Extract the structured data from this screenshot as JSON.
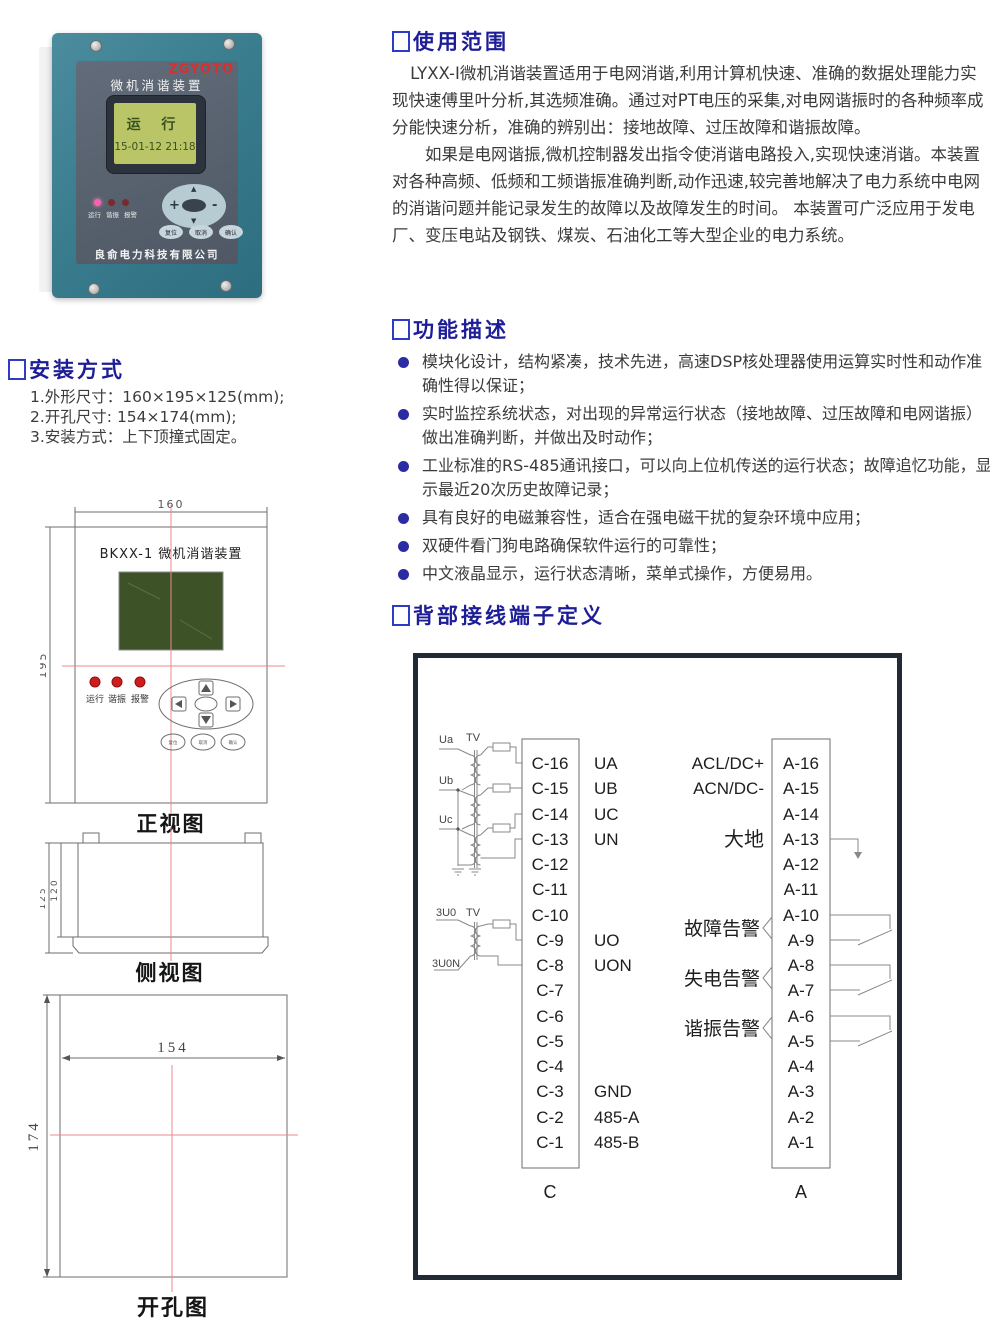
{
  "photo": {
    "brand": "ZGYOTO",
    "title": "微机消谐装置",
    "lcd_status": "运 行",
    "lcd_time": "15-01-12 21:18",
    "leds": [
      "运行",
      "谐振",
      "报警"
    ],
    "keys": {
      "plus": "+",
      "minus": "-",
      "up": "▲",
      "down": "▼"
    },
    "buttons": [
      "复位",
      "取消",
      "确认"
    ],
    "company": "良俞电力科技有限公司"
  },
  "usage": {
    "title": "使用范围",
    "p1": "LYXX-I微机消谐装置适用于电网消谐,利用计算机快速、准确的数据处理能力实现快速傅里叶分析,其选频准确。通过对PT电压的采集,对电网谐振时的各种频率成分能快速分析，准确的辨别出：接地故障、过压故障和谐振故障。",
    "p2": "如果是电网谐振,微机控制器发出指令使消谐电路投入,实现快速消谐。本装置对各种高频、低频和工频谐振准确判断,动作迅速,较完善地解决了电力系统中电网的消谐问题并能记录发生的故障以及故障发生的时间。 本装置可广泛应用于发电厂、变压电站及钢铁、煤炭、石油化工等大型企业的电力系统。"
  },
  "features": {
    "title": "功能描述",
    "items": [
      "模块化设计，结构紧凑，技术先进，高速DSP核处理器使用运算实时性和动作准确性得以保证；",
      "实时监控系统状态，对出现的异常运行状态（接地故障、过压故障和电网谐振）做出准确判断，并做出及时动作；",
      "工业标准的RS-485通讯接口，可以向上位机传送的运行状态；故障追忆功能，显示最近20次历史故障记录；",
      "具有良好的电磁兼容性，适合在强电磁干扰的复杂环境中应用；",
      "双硬件看门狗电路确保软件运行的可靠性；",
      "中文液晶显示，运行状态清晰，菜单式操作，方便易用。"
    ]
  },
  "install": {
    "title": "安装方式",
    "items": [
      "1.外形尺寸：160×195×125(mm);",
      "2.开孔尺寸: 154×174(mm);",
      "3.安装方式：上下顶撞式固定。"
    ]
  },
  "front_view": {
    "label": "正视图",
    "device_title": "BKXX-1 微机消谐装置",
    "dim_w": "160",
    "dim_h": "195",
    "leds": [
      "运行",
      "谐振",
      "报警"
    ],
    "buttons": [
      "复位",
      "取消",
      "确认"
    ]
  },
  "side_view": {
    "label": "侧视图",
    "dim_outer": "125",
    "dim_inner": "120"
  },
  "cutout_view": {
    "label": "开孔图",
    "dim_w": "154",
    "dim_h": "174"
  },
  "terminals": {
    "title": "背部接线端子定义"
  },
  "diagram": {
    "c": {
      "name": "C",
      "ids": [
        "C-16",
        "C-15",
        "C-14",
        "C-13",
        "C-12",
        "C-11",
        "C-10",
        "C-9",
        "C-8",
        "C-7",
        "C-6",
        "C-5",
        "C-4",
        "C-3",
        "C-2",
        "C-1"
      ],
      "signals": {
        "0": "UA",
        "1": "UB",
        "2": "UC",
        "3": "UN",
        "7": "UO",
        "8": "UON",
        "13": "GND",
        "14": "485-A",
        "15": "485-B"
      }
    },
    "a": {
      "name": "A",
      "ids": [
        "A-16",
        "A-15",
        "A-14",
        "A-13",
        "A-12",
        "A-11",
        "A-10",
        "A-9",
        "A-8",
        "A-7",
        "A-6",
        "A-5",
        "A-4",
        "A-3",
        "A-2",
        "A-1"
      ],
      "labels": {
        "acl": "ACL/DC+",
        "acn": "ACN/DC-",
        "earth": "大地",
        "fault": "故障告警",
        "loss": "失电告警",
        "resonance": "谐振告警"
      }
    },
    "pt": {
      "ua": "Ua",
      "ub": "Ub",
      "uc": "Uc",
      "tv": "TV",
      "u0": "3U0",
      "u0n": "3U0N"
    }
  }
}
